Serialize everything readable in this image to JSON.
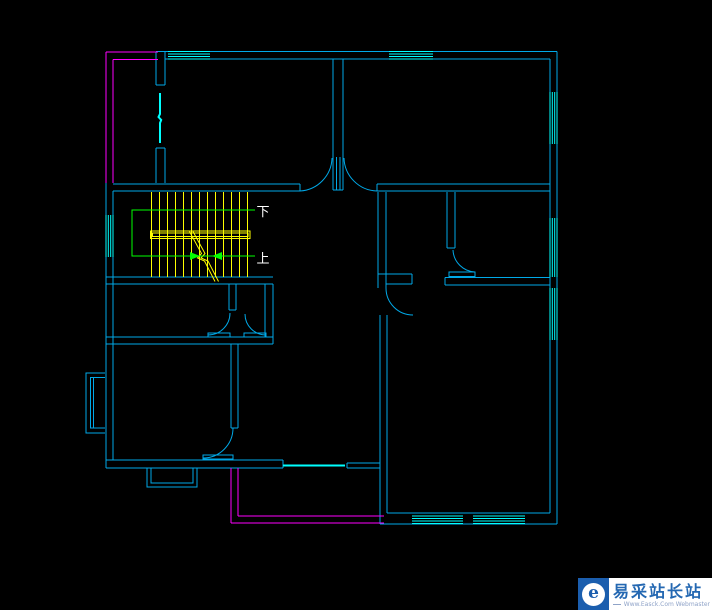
{
  "canvas": {
    "width": 712,
    "height": 610,
    "background": "#000000"
  },
  "colors": {
    "canvas": "#000000",
    "wall": "#00a9e8",
    "window": "#00ffff",
    "magenta": "#ff00ff",
    "stair": "#ffff00",
    "path": "#00ff00",
    "label": "#ffffff",
    "logo_box": "#1b5eae",
    "logo_bg": "#ffffff",
    "logo_title": "#2468b2",
    "logo_subtitle": "#8fa3c8"
  },
  "stair": {
    "down_label": "下",
    "up_label": "上"
  },
  "watermark": {
    "icon_glyph": "e",
    "title": "易采站长站",
    "subtitle": "Www.Easck.Com Webmaster"
  }
}
